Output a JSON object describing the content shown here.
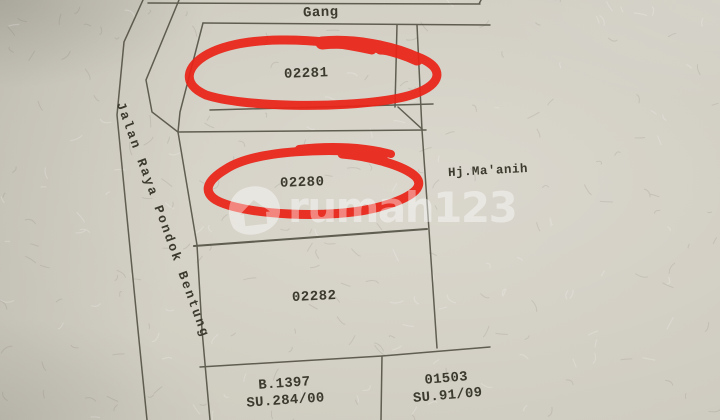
{
  "map": {
    "gang_label": "Gang",
    "road_label": "Jalan Raya Pondok Bentung",
    "owner_label": "Hj.Ma'anih",
    "parcels": [
      {
        "id": "02281",
        "circled": true
      },
      {
        "id": "02280",
        "circled": true
      },
      {
        "id": "02282",
        "circled": false
      }
    ],
    "bottom_parcels": [
      {
        "line1": "B.1397",
        "line2": "SU.284/00"
      },
      {
        "line1": "01503",
        "line2": "SU.91/09"
      }
    ],
    "colors": {
      "annotation_red": "#ea2418",
      "boundary_line": "#4c4a3c",
      "paper": "#cdcabf",
      "paper_highlight": "#d5d1c6",
      "paper_shadow": "#c1beb3",
      "text_ink": "#3c3a2f",
      "watermark_white": "rgba(255,255,255,0.42)"
    }
  },
  "watermark": {
    "text": "rumah123",
    "logo": "rumah123-pin-logo"
  }
}
